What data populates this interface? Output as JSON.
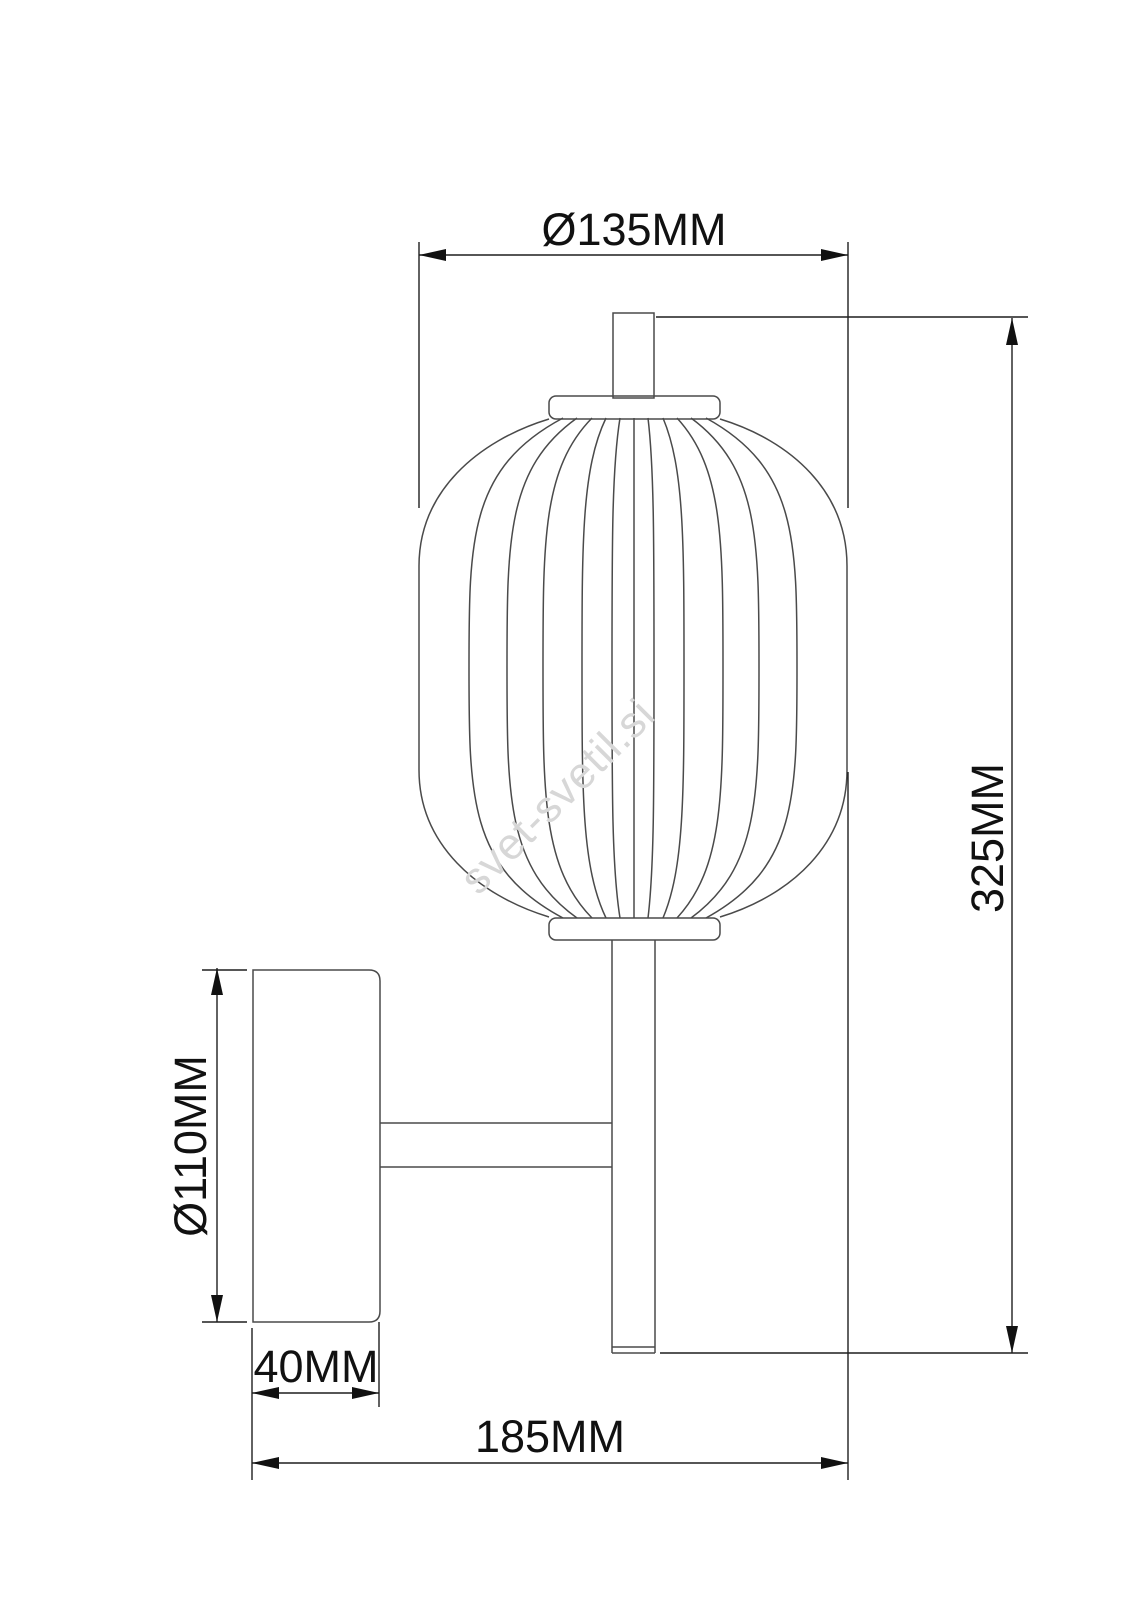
{
  "drawing": {
    "type": "technical-dimension-drawing",
    "subject": "wall lamp with ribbed lantern shade, wall plate and support arm",
    "watermark_text": "svet-svetil.si",
    "dimensions": {
      "shade_diameter": "Ø135MM",
      "total_height": "325MM",
      "plate_diameter": "Ø110MM",
      "plate_depth": "40MM",
      "total_projection": "185MM"
    },
    "colors": {
      "outline": "#4a4a4a",
      "dimension_line": "#1f1f1f",
      "text": "#111111",
      "watermark": "#d7d7d7",
      "background": "#ffffff"
    }
  }
}
